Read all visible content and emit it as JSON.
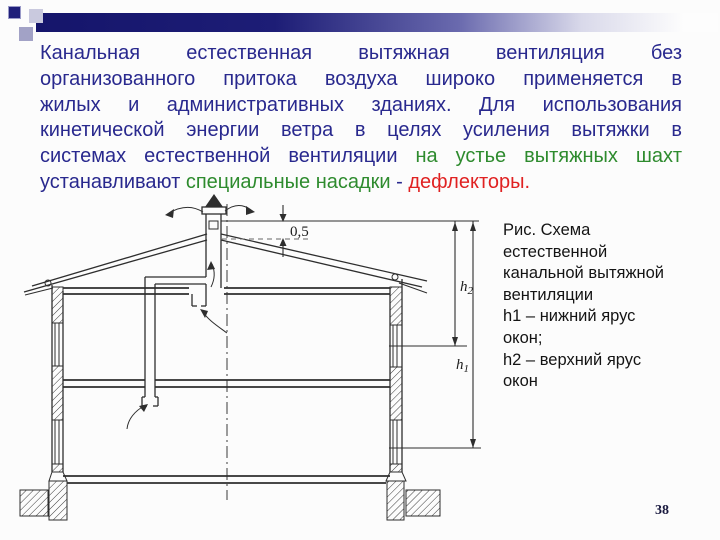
{
  "slide": {
    "background": "#fcfcfc",
    "page_number": "38"
  },
  "header_bar": {
    "color_left": "#15156b"
  },
  "paragraph": {
    "colors": {
      "blue": "#29298e",
      "green": "#2e8b2e",
      "red": "#e02222"
    },
    "lines": [
      {
        "segments": [
          {
            "t": "Канальная естественная вытяжная вентиляция без",
            "c": "blue"
          }
        ]
      },
      {
        "segments": [
          {
            "t": "организованного притока воздуха широко применяется в",
            "c": "blue"
          }
        ]
      },
      {
        "segments": [
          {
            "t": "жилых и административных зданиях. Для использования",
            "c": "blue"
          }
        ]
      },
      {
        "segments": [
          {
            "t": "кинетической энергии ветра в целях усиления вытяжки в",
            "c": "blue"
          }
        ]
      },
      {
        "segments": [
          {
            "t": "системах естественной вентиляции ",
            "c": "blue"
          },
          {
            "t": "на устье вытяжных шахт",
            "c": "green"
          }
        ]
      },
      {
        "segments": [
          {
            "t": "устанавливают ",
            "c": "blue"
          },
          {
            "t": "специальные насадки",
            "c": "green"
          },
          {
            "t": " - ",
            "c": "blue"
          },
          {
            "t": "дефлекторы.",
            "c": "red"
          }
        ]
      }
    ]
  },
  "caption": {
    "lines": [
      "Рис. Схема",
      "естественной",
      "канальной вытяжной",
      "вентиляции",
      "h1 – нижний ярус",
      "окон;",
      "h2 – верхний ярус",
      "окон"
    ]
  },
  "diagram": {
    "labels": {
      "offset": "0,5",
      "h2_base": "h",
      "h2_sub": "2",
      "h1_base": "h",
      "h1_sub": "1"
    }
  }
}
